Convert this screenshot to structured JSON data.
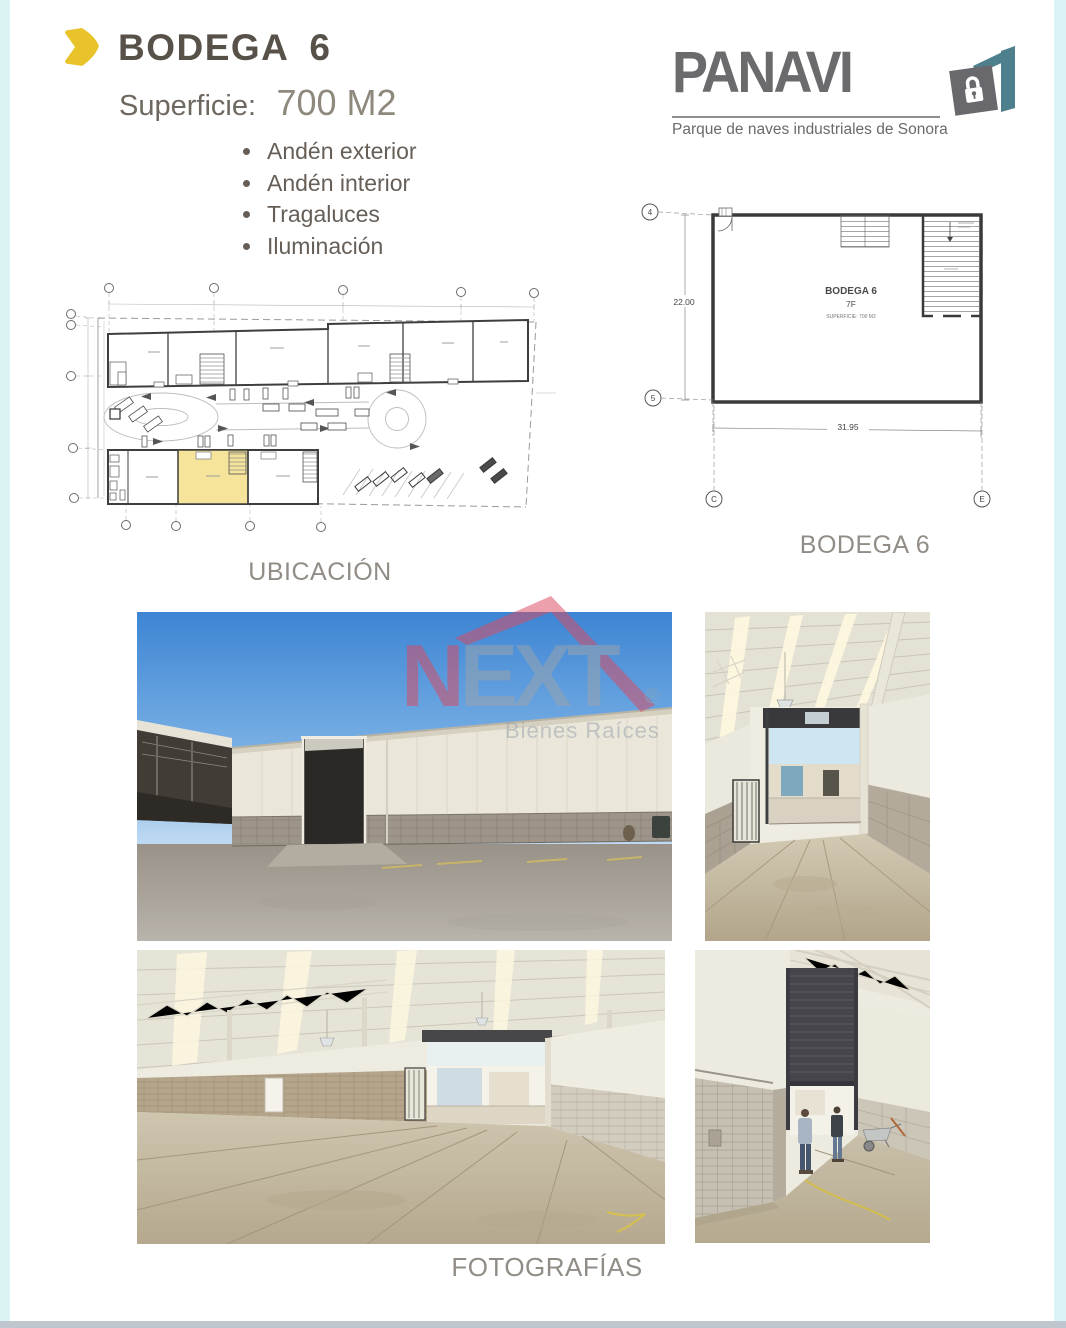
{
  "header": {
    "title_word": "BODEGA",
    "title_number": "6",
    "superficie_label": "Superficie:",
    "superficie_value": "700 M2",
    "features": [
      "Andén exterior",
      "Andén interior",
      "Tragaluces",
      "Iluminación"
    ]
  },
  "brand": {
    "name": "PANAVI",
    "tagline": "Parque de naves industriales de Sonora"
  },
  "site_plan": {
    "caption": "UBICACIÓN"
  },
  "floor_plan": {
    "caption": "BODEGA 6",
    "room_name": "BODEGA 6",
    "room_level": "7F",
    "room_area": "SUPERFICIE: 700 M2",
    "dim_left": "22.00",
    "dim_bottom": "31.95",
    "grid_top": "4",
    "grid_bottom": "5",
    "grid_col_left": "C",
    "grid_col_right": "E"
  },
  "photos": {
    "caption": "FOTOGRAFÍAS"
  },
  "watermark": {
    "brand_first": "N",
    "brand_rest": "EXT",
    "registered": "®",
    "subtitle": "Bienes Raíces"
  },
  "colors": {
    "accent_yellow": "#e9c32a",
    "brand_gray": "#6b6b6e",
    "brand_teal": "#4e7f8c",
    "highlight_unit_yellow": "#f6e49b",
    "watermark_red": "#d94b61",
    "watermark_gray": "#9ba3ac",
    "caption_gray": "#918d86"
  }
}
